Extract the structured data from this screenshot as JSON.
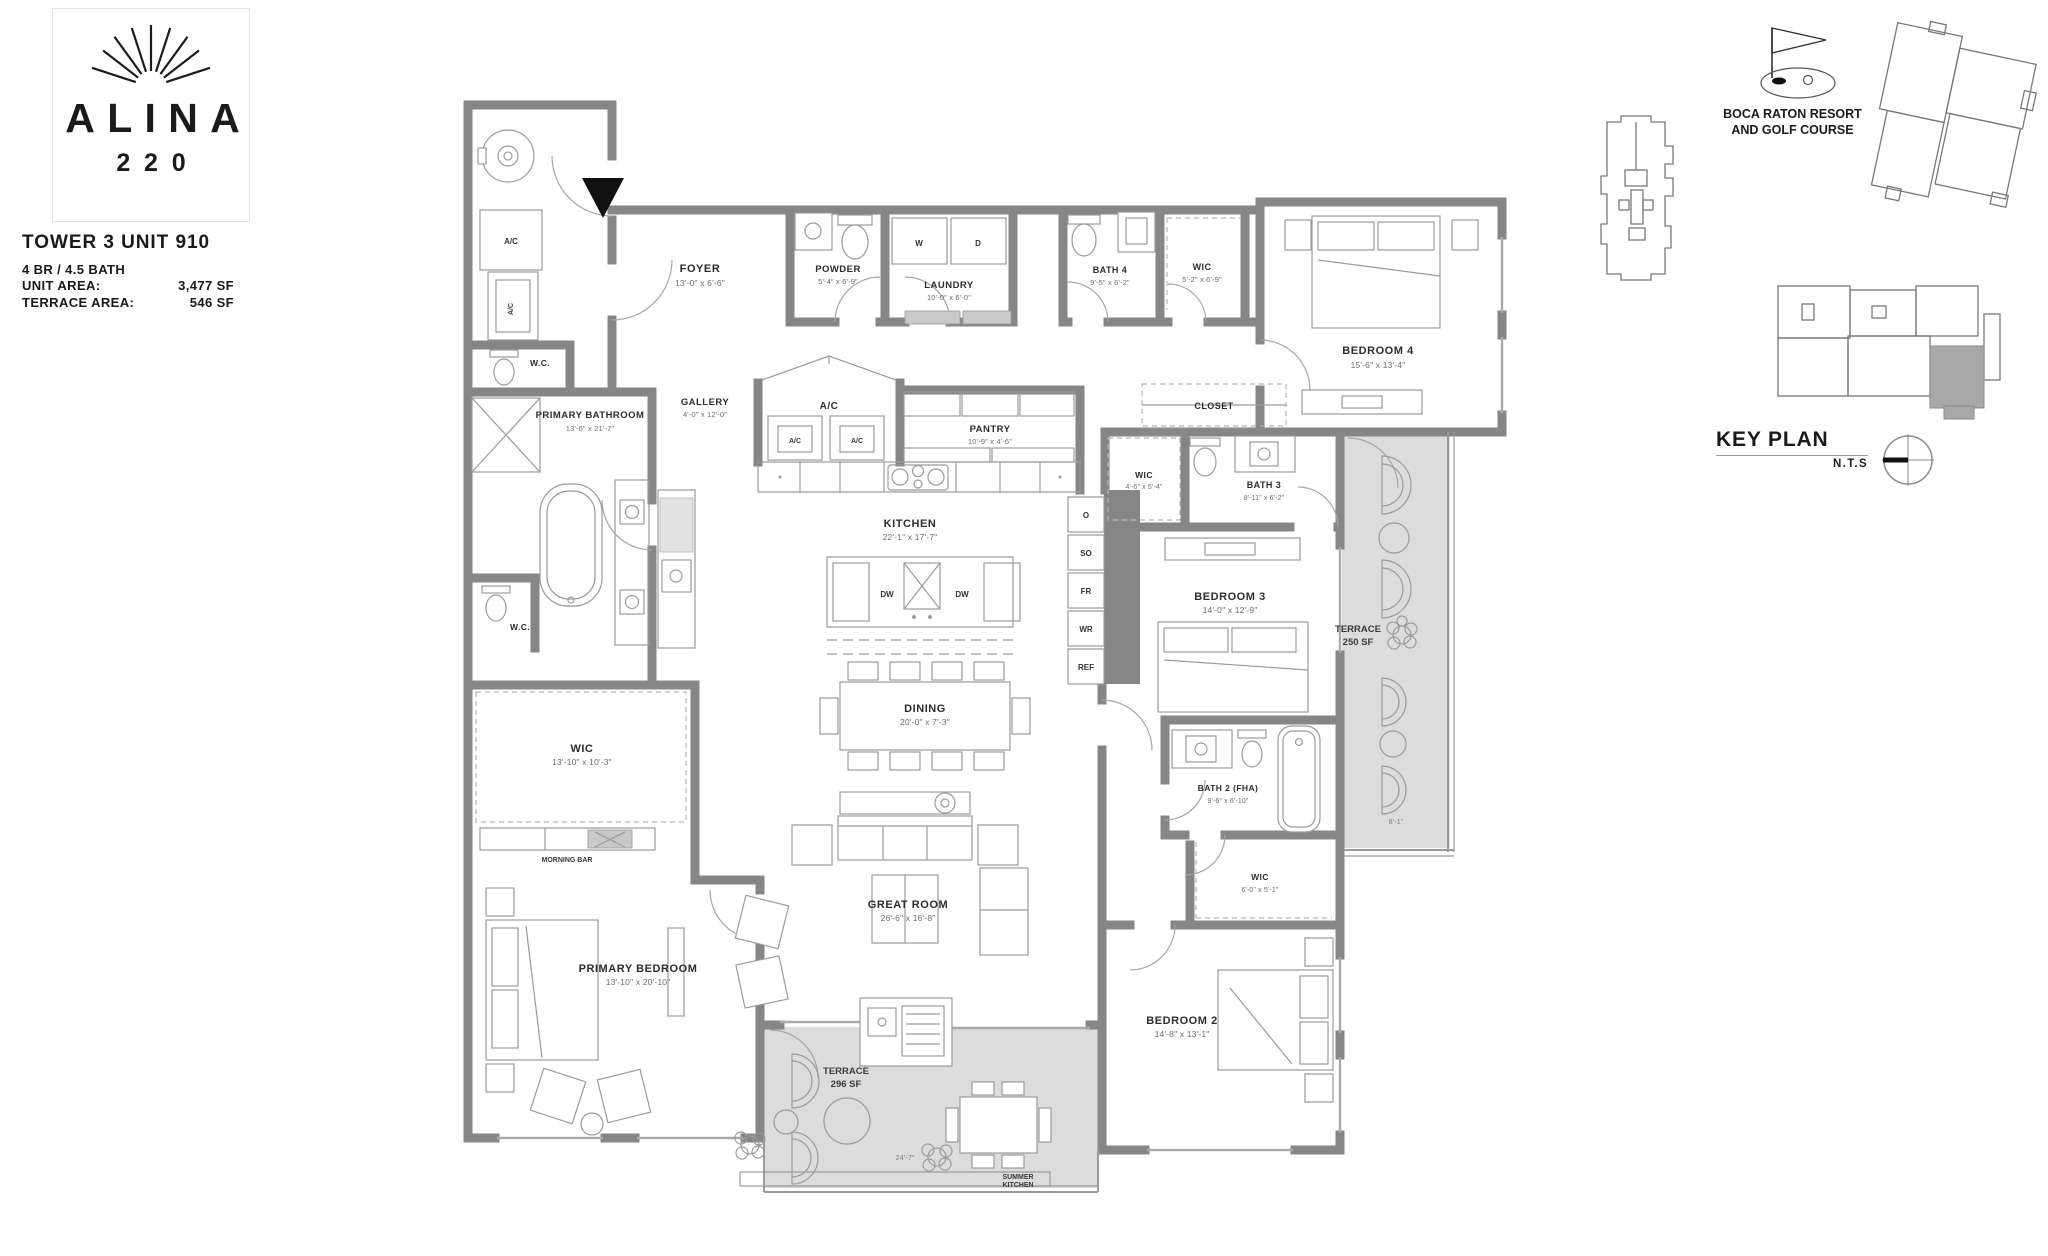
{
  "branding": {
    "name": "ALINA",
    "number": "220"
  },
  "unit": {
    "title": "TOWER 3 UNIT 910",
    "config": "4 BR / 4.5 BATH",
    "unit_area_label": "UNIT AREA:",
    "unit_area_value": "3,477 SF",
    "terrace_area_label": "TERRACE AREA:",
    "terrace_area_value": "546 SF"
  },
  "key_plan": {
    "title": "KEY PLAN",
    "scale": "N.T.S",
    "location_line1": "BOCA RATON RESORT",
    "location_line2": "AND GOLF COURSE"
  },
  "rooms": {
    "foyer": {
      "name": "FOYER",
      "dims": "13'-0\" x 6'-6\""
    },
    "powder": {
      "name": "POWDER",
      "dims": "5'-4\" x 6'-9\""
    },
    "laundry": {
      "name": "LAUNDRY",
      "dims": "10'-0\" x 6'-0\""
    },
    "bath4": {
      "name": "BATH 4",
      "dims": "9'-5\" x 6'-2\""
    },
    "wic4": {
      "name": "WIC",
      "dims": "5'-2\" x 6'-9\""
    },
    "bedroom4": {
      "name": "BEDROOM 4",
      "dims": "15'-6\" x 13'-4\""
    },
    "gallery": {
      "name": "GALLERY",
      "dims": "4'-0\" x 12'-0\""
    },
    "ac_room": {
      "name": "A/C"
    },
    "pantry": {
      "name": "PANTRY",
      "dims": "10'-9\" x 4'-6\""
    },
    "closet": {
      "name": "CLOSET"
    },
    "wc": {
      "name": "W.C."
    },
    "kitchen": {
      "name": "KITCHEN",
      "dims": "22'-1\" x 17'-7\""
    },
    "wic3": {
      "name": "WIC",
      "dims": "4'-6\" x 5'-4\""
    },
    "bath3": {
      "name": "BATH 3",
      "dims": "8'-11\" x 6'-2\""
    },
    "bedroom3": {
      "name": "BEDROOM 3",
      "dims": "14'-0\" x 12'-9\""
    },
    "terrace_east": {
      "name": "TERRACE",
      "area": "250 SF"
    },
    "wic_primary": {
      "name": "WIC",
      "dims": "13'-10\" x 10'-3\""
    },
    "dining": {
      "name": "DINING",
      "dims": "20'-0\" x 7'-3\""
    },
    "great_room": {
      "name": "GREAT ROOM",
      "dims": "26'-6\" x 16'-8\""
    },
    "morning_bar": {
      "name": "MORNING BAR"
    },
    "primary_bathroom": {
      "name": "PRIMARY BATHROOM",
      "dims": "13'-6\" x 21'-7\""
    },
    "primary_bedroom": {
      "name": "PRIMARY BEDROOM",
      "dims": "13'-10\" x 20'-10\""
    },
    "bath2": {
      "name": "BATH 2 (FHA)",
      "dims": "9'-6\" x 6'-10\""
    },
    "wic2": {
      "name": "WIC",
      "dims": "6'-0\" x 5'-1\""
    },
    "bedroom2": {
      "name": "BEDROOM 2",
      "dims": "14'-8\" x 13'-1\""
    },
    "terrace_south": {
      "name": "TERRACE",
      "area": "296 SF"
    },
    "summer_kitchen": {
      "line1": "SUMMER",
      "line2": "KITCHEN"
    }
  },
  "appliances": {
    "washer": "W",
    "dryer": "D",
    "dishwasher": "DW",
    "oven": "O",
    "speed_oven": "SO",
    "fridge": "FR",
    "wine": "WR",
    "refrigerator": "REF",
    "ac": "A/C"
  },
  "dimensions": {
    "terrace_south_width": "24'-7\"",
    "terrace_east_depth": "8'-1\""
  }
}
